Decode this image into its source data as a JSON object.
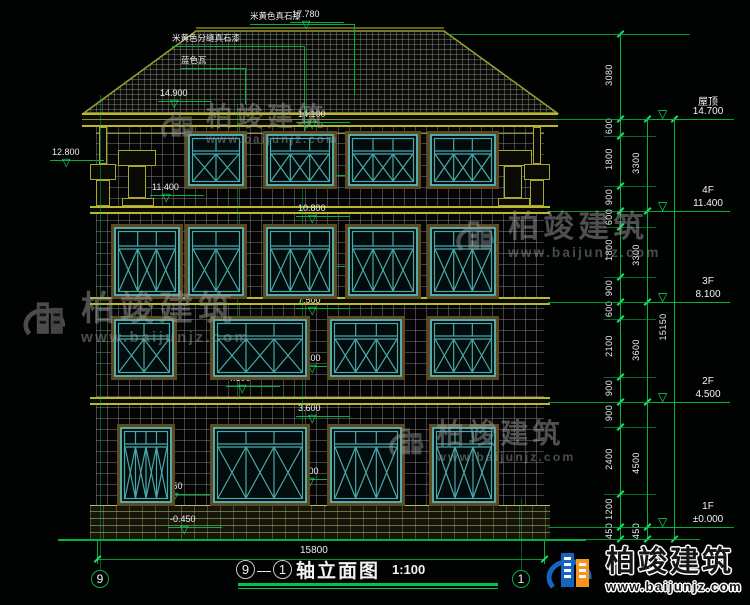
{
  "title": {
    "axis_start": "9",
    "separator": "—",
    "axis_end": "1",
    "name": "轴立面图",
    "scale": "1:100"
  },
  "grid_bubbles": {
    "left": "9",
    "right": "1"
  },
  "bottom_dimension": "15800",
  "watermark": {
    "name": "柏竣建筑",
    "site": "www.baijunjz.com"
  },
  "materials": [
    {
      "text": "米黄色真石漆",
      "x": 250,
      "y": 10,
      "w": 104,
      "drop": 70
    },
    {
      "text": "米黄色分缝真石漆",
      "x": 172,
      "y": 32,
      "w": 132,
      "drop": 88
    },
    {
      "text": "蓝色瓦",
      "x": 181,
      "y": 54,
      "w": 64,
      "drop": 36
    }
  ],
  "elevation_markers": [
    {
      "label": "17.780",
      "x": 290,
      "y": 33
    },
    {
      "label": "14.900",
      "x": 158,
      "y": 112
    },
    {
      "label": "14.100",
      "x": 296,
      "y": 133
    },
    {
      "label": "12.800",
      "x": 50,
      "y": 171
    },
    {
      "label": "12.300",
      "x": 296,
      "y": 186
    },
    {
      "label": "11.400",
      "x": 150,
      "y": 206
    },
    {
      "label": "10.800",
      "x": 296,
      "y": 227
    },
    {
      "label": "9.000",
      "x": 296,
      "y": 277
    },
    {
      "label": "7.500",
      "x": 296,
      "y": 319
    },
    {
      "label": "5.400",
      "x": 296,
      "y": 377
    },
    {
      "label": "4.500",
      "x": 226,
      "y": 397
    },
    {
      "label": "3.600",
      "x": 296,
      "y": 427
    },
    {
      "label": "1.200",
      "x": 294,
      "y": 490
    },
    {
      "label": "0.650",
      "x": 158,
      "y": 505
    },
    {
      "label": "-0.450",
      "x": 168,
      "y": 538
    }
  ],
  "right_panel": {
    "chains": [
      {
        "x": 620,
        "items": [
          [
            "3080",
            34,
            119
          ],
          [
            "600",
            119,
            136
          ],
          [
            "1800",
            136,
            186
          ],
          [
            "900",
            186,
            211
          ],
          [
            "600",
            211,
            227
          ],
          [
            "1800",
            227,
            277
          ],
          [
            "900",
            277,
            302
          ],
          [
            "600",
            302,
            319
          ],
          [
            "2100",
            319,
            377
          ],
          [
            "900",
            377,
            402
          ],
          [
            "900",
            402,
            427
          ],
          [
            "2400",
            427,
            494
          ],
          [
            "1200",
            494,
            527
          ],
          [
            "450",
            527,
            539
          ]
        ]
      },
      {
        "x": 647,
        "items": [
          [
            "3300",
            119,
            211
          ],
          [
            "3300",
            211,
            302
          ],
          [
            "3600",
            302,
            402
          ],
          [
            "4500",
            402,
            527
          ],
          [
            "450",
            527,
            539
          ]
        ]
      },
      {
        "x": 674,
        "items": [
          [
            "15150",
            119,
            539
          ]
        ]
      }
    ],
    "floors": [
      {
        "name": "屋顶",
        "elev": "14.700",
        "y": 119
      },
      {
        "name": "4F",
        "elev": "11.400",
        "y": 211
      },
      {
        "name": "3F",
        "elev": "8.100",
        "y": 302
      },
      {
        "name": "2F",
        "elev": "4.500",
        "y": 402
      },
      {
        "name": "1F",
        "elev": "±0.000",
        "y": 527
      }
    ]
  },
  "windows": {
    "rows": [
      {
        "y": 134,
        "h": 52,
        "transom": 0.32,
        "items": [
          {
            "x": 188,
            "w": 56,
            "cols": 2
          },
          {
            "x": 266,
            "w": 68,
            "cols": 3
          },
          {
            "x": 348,
            "w": 70,
            "cols": 3
          },
          {
            "x": 430,
            "w": 66,
            "cols": 3
          }
        ]
      },
      {
        "y": 227,
        "h": 69,
        "transom": 0.28,
        "items": [
          {
            "x": 114,
            "w": 66,
            "cols": 3
          },
          {
            "x": 188,
            "w": 56,
            "cols": 2
          },
          {
            "x": 266,
            "w": 68,
            "cols": 3
          },
          {
            "x": 348,
            "w": 70,
            "cols": 3
          },
          {
            "x": 430,
            "w": 66,
            "cols": 3
          }
        ]
      },
      {
        "y": 319,
        "h": 58,
        "transom": 0.3,
        "items": [
          {
            "x": 114,
            "w": 60,
            "cols": 2
          },
          {
            "x": 213,
            "w": 94,
            "cols": 3
          },
          {
            "x": 330,
            "w": 72,
            "cols": 3
          },
          {
            "x": 430,
            "w": 66,
            "cols": 3
          }
        ]
      },
      {
        "y": 427,
        "h": 76,
        "transom": 0.22,
        "items": [
          {
            "x": 120,
            "w": 52,
            "cols": 4,
            "door": true
          },
          {
            "x": 213,
            "w": 94,
            "cols": 3
          },
          {
            "x": 330,
            "w": 72,
            "cols": 3
          },
          {
            "x": 432,
            "w": 64,
            "cols": 3
          }
        ]
      }
    ]
  },
  "watermarks_pos": [
    {
      "x": 160,
      "y": 104,
      "s": 0.78
    },
    {
      "x": 22,
      "y": 292,
      "s": 1
    },
    {
      "x": 455,
      "y": 212,
      "s": 0.9
    },
    {
      "x": 388,
      "y": 420,
      "s": 0.82
    }
  ]
}
